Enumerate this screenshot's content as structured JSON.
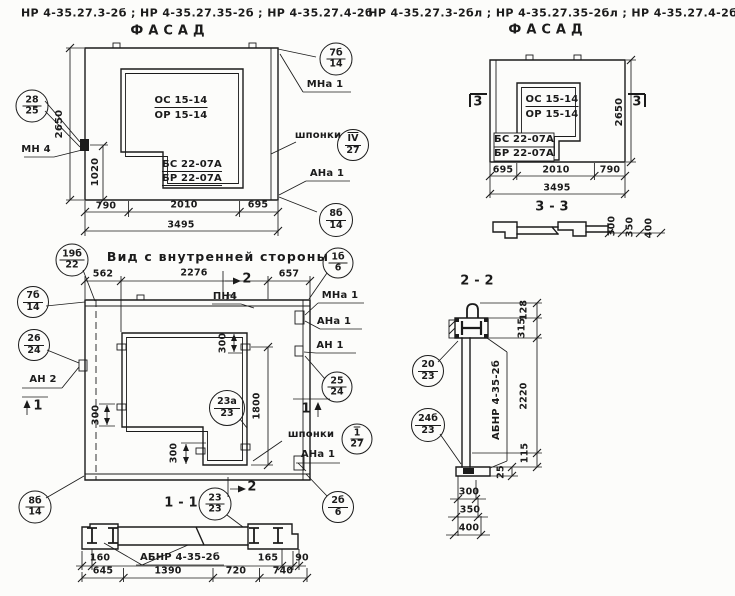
{
  "headers": {
    "left_codes": "НР 4-35.27.3-2б ;   НР 4-35.27.35-2б ;   НР 4-35.27.4-2б",
    "left_title": "ФАСАД",
    "right_codes": "НР 4-35.27.3-2бл ;  НР 4-35.27.35-2бл ;  НР 4-35.27.4-2бл",
    "right_title": "ФАСАД"
  },
  "facade_left": {
    "opening_mark_top": "ОС 15-14",
    "opening_mark_bottom": "ОР 15-14",
    "block_mark_top": "БС 22-07А",
    "block_mark_bottom": "БР 22-07А",
    "label_mn4": "МН 4",
    "label_mna1": "МНа 1",
    "label_shponki": "шпонки",
    "label_ana1": "АНа 1",
    "dim_height": "2650",
    "dim_anchor": "1020",
    "dim_a": "790",
    "dim_b": "2010",
    "dim_c": "695",
    "dim_total": "3495",
    "balloon_28_25": {
      "top": "28",
      "bottom": "25"
    },
    "balloon_7b_14": {
      "top": "7б",
      "bottom": "14"
    },
    "balloon_iv_27": {
      "top": "IV",
      "bottom": "27"
    },
    "balloon_8b_14": {
      "top": "8б",
      "bottom": "14"
    }
  },
  "inner_view": {
    "title": "Вид с внутренней стороны",
    "dim_a": "562",
    "dim_b": "2276",
    "dim_c": "657",
    "label_pn4": "ПН4",
    "label_an2": "АН 2",
    "label_mna1": "МНа 1",
    "label_ana1_top": "АНа 1",
    "label_an1": "АН 1",
    "label_shponki": "шпонки",
    "label_ana1_bottom": "АНа 1",
    "dim_300_left": "300",
    "dim_300_top": "300",
    "dim_300_bottom": "300",
    "dim_1800": "1800",
    "marker_1": "1",
    "marker_2": "2",
    "balloon_19b_22": {
      "top": "19б",
      "bottom": "22"
    },
    "balloon_7b_14": {
      "top": "7б",
      "bottom": "14"
    },
    "balloon_26_24": {
      "top": "26",
      "bottom": "24"
    },
    "balloon_23a_23": {
      "top": "23а",
      "bottom": "23"
    },
    "balloon_25_24": {
      "top": "25",
      "bottom": "24"
    },
    "balloon_1_27": {
      "top": "1",
      "bottom": "27"
    },
    "balloon_1b_6": {
      "top": "1б",
      "bottom": "6"
    },
    "balloon_2b_6": {
      "top": "2б",
      "bottom": "6"
    },
    "balloon_8b_14": {
      "top": "8б",
      "bottom": "14"
    }
  },
  "section_1_1": {
    "title": "1 - 1",
    "balloon_23_23": {
      "top": "23",
      "bottom": "23"
    },
    "label_abnr": "АБНР 4-35-2б",
    "dim_160": "160",
    "dim_165": "165",
    "dim_90": "90",
    "dim_645": "645",
    "dim_1390": "1390",
    "dim_720": "720",
    "dim_740": "740"
  },
  "facade_right": {
    "opening_mark_top": "ОС 15-14",
    "opening_mark_bottom": "ОР 15-14",
    "block_mark_top": "БС 22-07А",
    "block_mark_bottom": "БР 22-07А",
    "marker_3": "3",
    "dim_height": "2650",
    "dim_a": "695",
    "dim_b": "2010",
    "dim_c": "790",
    "dim_total": "3495"
  },
  "section_3_3": {
    "title": "3 - 3",
    "dim_a": "300",
    "dim_b": "350",
    "dim_c": "400"
  },
  "section_2_2": {
    "title": "2 - 2",
    "label_abnr": "АБНР 4-35-2б",
    "dim_128": "128",
    "dim_315": "315",
    "dim_2220": "2220",
    "dim_115": "115",
    "dim_25": "25",
    "dim_300": "300",
    "dim_350": "350",
    "dim_400": "400",
    "balloon_20_23": {
      "top": "20",
      "bottom": "23"
    },
    "balloon_24b_23": {
      "top": "24б",
      "bottom": "23"
    }
  }
}
